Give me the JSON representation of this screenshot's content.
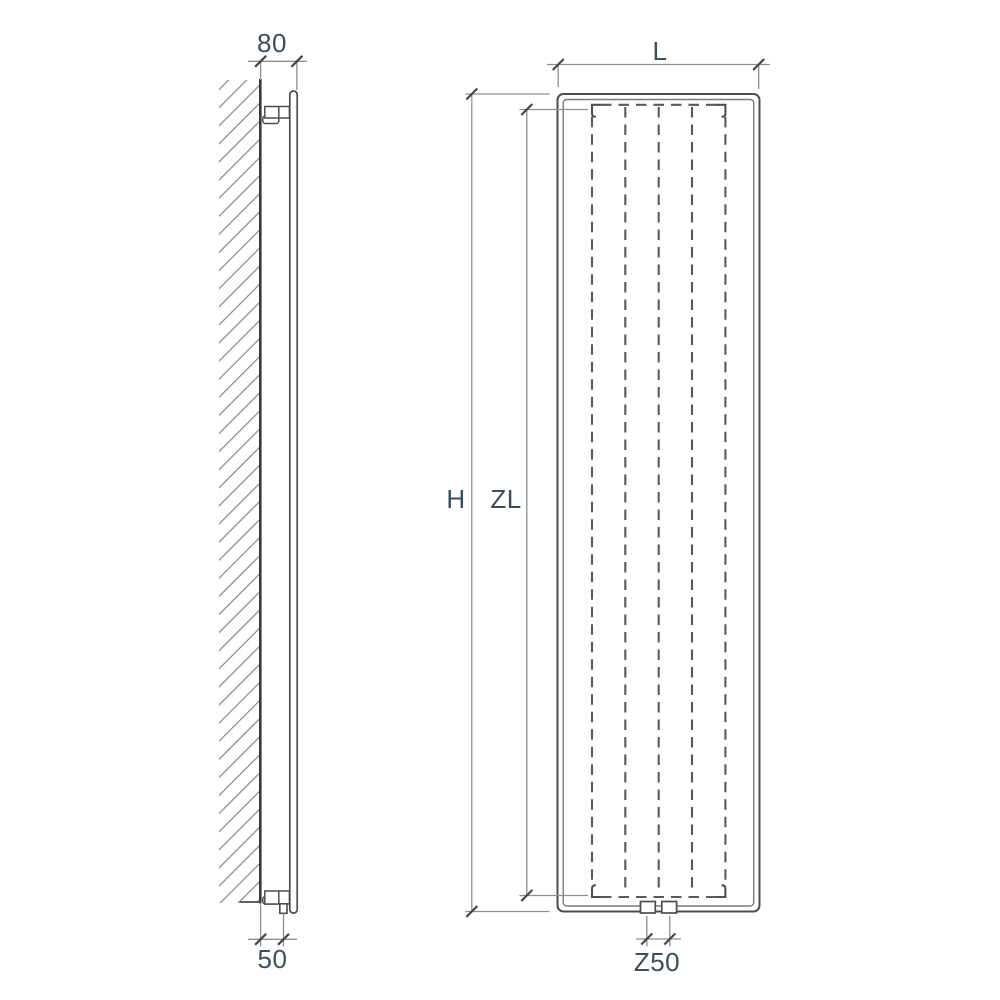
{
  "diagram": {
    "labels": {
      "depth": "80",
      "bottom_clearance": "50",
      "width": "L",
      "height": "H",
      "element_height": "ZL",
      "connection_spacing": "Z50"
    },
    "colors": {
      "background": "#ffffff",
      "outline": "#4d4d4d",
      "inner_line": "#7a7a7a",
      "dashed_line": "#5a5a5a",
      "wall_line": "#383838",
      "hatch_line": "#868686",
      "dim_line": "#8f8f8f",
      "tick": "#454545",
      "label_text": "#3e4e59"
    }
  }
}
